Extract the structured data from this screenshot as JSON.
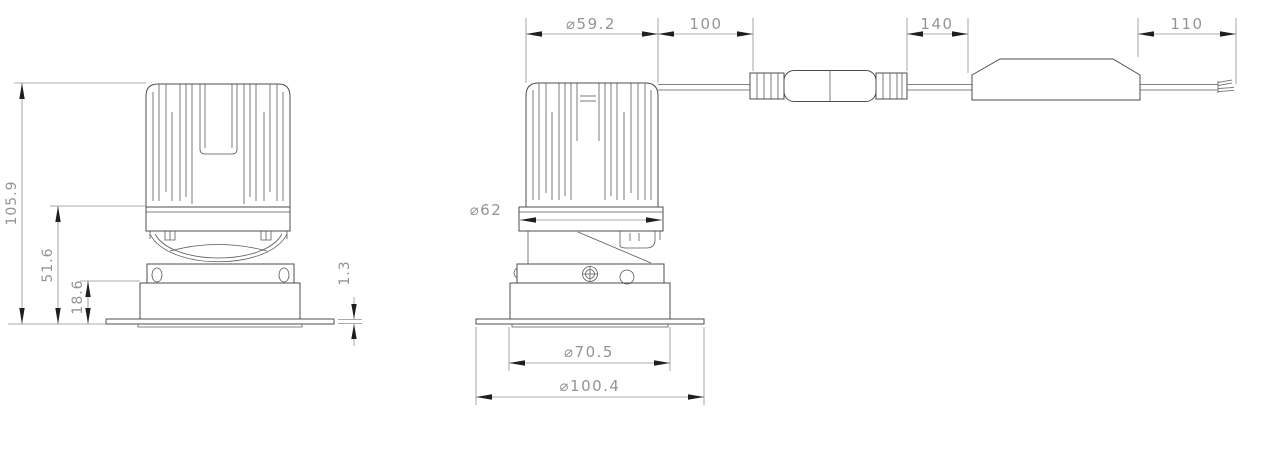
{
  "colors": {
    "background": "#ffffff",
    "object_line": "#4d4d4d",
    "dimension_line": "#8f8f8f",
    "arrow": "#1f1f1f",
    "dimension_text": "#949494"
  },
  "drawing": {
    "type": "recessed-downlight-dimension-drawing",
    "views": {
      "front_view": {
        "overall_height": "105.9",
        "body_height": "51.6",
        "recess_depth": "18.6",
        "flange_thickness": "1.3"
      },
      "side_view": {
        "heatsink_diameter": "⌀59.2",
        "body_diameter": "⌀62",
        "cutout_diameter": "⌀70.5",
        "flange_diameter": "⌀100.4"
      },
      "cable_run": {
        "fixture_lead": "100",
        "driver_lead": "140",
        "output_lead": "110"
      }
    }
  }
}
